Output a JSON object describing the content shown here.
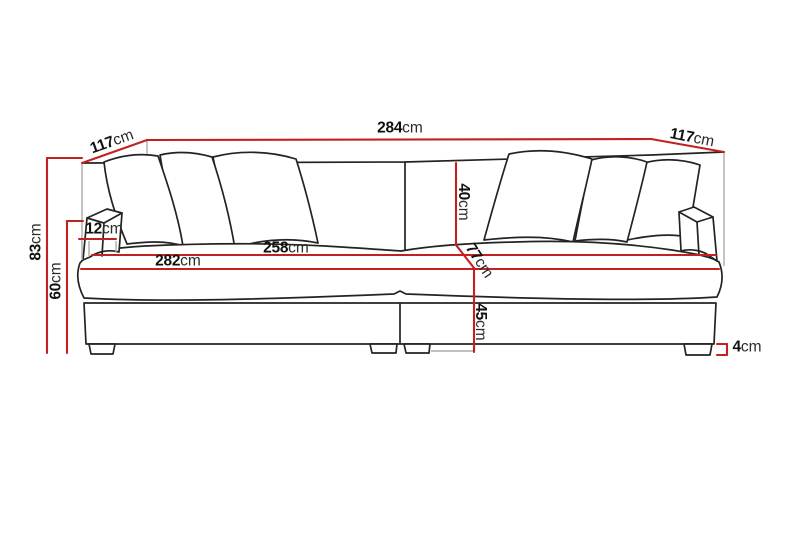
{
  "diagram": {
    "title": "sofa-dimension-diagram",
    "unit": "cm",
    "colors": {
      "dimension_line": "#c42020",
      "outline": "#232323",
      "extension_line": "#ababab",
      "label_text": "#111111",
      "background": "#ffffff"
    },
    "dimensions": {
      "back_width": {
        "value": "284",
        "unit": "cm"
      },
      "depth_left": {
        "value": "117",
        "unit": "cm"
      },
      "depth_right": {
        "value": "117",
        "unit": "cm"
      },
      "total_height": {
        "value": "83",
        "unit": "cm"
      },
      "arm_height": {
        "value": "60",
        "unit": "cm"
      },
      "arm_width": {
        "value": "12",
        "unit": "cm"
      },
      "inner_seat_width": {
        "value": "258",
        "unit": "cm"
      },
      "front_width": {
        "value": "282",
        "unit": "cm"
      },
      "back_cushion_height": {
        "value": "40",
        "unit": "cm"
      },
      "seat_depth": {
        "value": "77",
        "unit": "cm"
      },
      "seat_height": {
        "value": "45",
        "unit": "cm"
      },
      "leg_height": {
        "value": "4",
        "unit": "cm"
      }
    }
  }
}
